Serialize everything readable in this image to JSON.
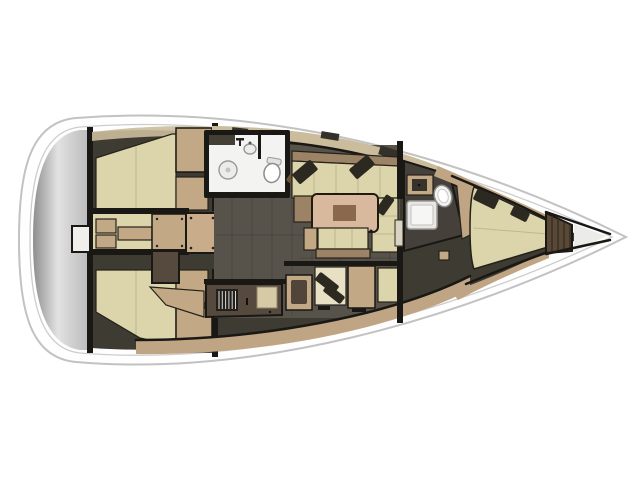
{
  "meta": {
    "title": "Sailing yacht interior layout plan, top view, bow pointing right",
    "type": "floor-plan",
    "cabins": "3 cabins, 2 heads, saloon with galley and nav station"
  },
  "features": [
    "swim-platform",
    "aft-cabin-port",
    "aft-cabin-starboard",
    "engine-compartment",
    "companionway-stairs",
    "aft-head",
    "saloon",
    "saloon-table",
    "settee",
    "galley",
    "nav-station",
    "forward-head",
    "v-berth",
    "anchor-locker",
    "bow"
  ],
  "colors": {
    "background": "#ffffff",
    "hull_fill": "#fefefe",
    "hull_stroke": "#c2c2c2",
    "deck_line": "#cdcdcd",
    "transom_dark": "#8e8e8e",
    "transom_light": "#e2e2e2",
    "transom_mid": "#bcbcbc",
    "wall": "#1a1815",
    "interior_base": "#3e3b32",
    "salon_floor": "#57534b",
    "berth": "#dcd5ab",
    "seat": "#e7e0c4",
    "wood": "#c3a886",
    "wood_dark": "#9d8365",
    "counter": "#554a3d",
    "table": "#d8b99e",
    "table_center": "#8a684e",
    "pillow": "#2b2920",
    "bathroom": "#f3f3f1",
    "fixture": "#ececea",
    "fixture_stroke": "#9a9a9a",
    "deck_beige": "#cbbd9b",
    "band_tan": "#bfa584",
    "bow_locker": "#584836",
    "bow_tip": "#ebebe8",
    "door_wood": "#6b5436",
    "grille_dark": "#23201b",
    "grille_slat": "#d8d8d8",
    "hatch_dark": "#34312a",
    "door_light": "#d9d4c2",
    "sink_cover": "#d6c9a6",
    "stairs_bg": "#8a7154",
    "stairs_ridge": "#c9ae8c",
    "stairs_base": "#c9ad8a"
  }
}
